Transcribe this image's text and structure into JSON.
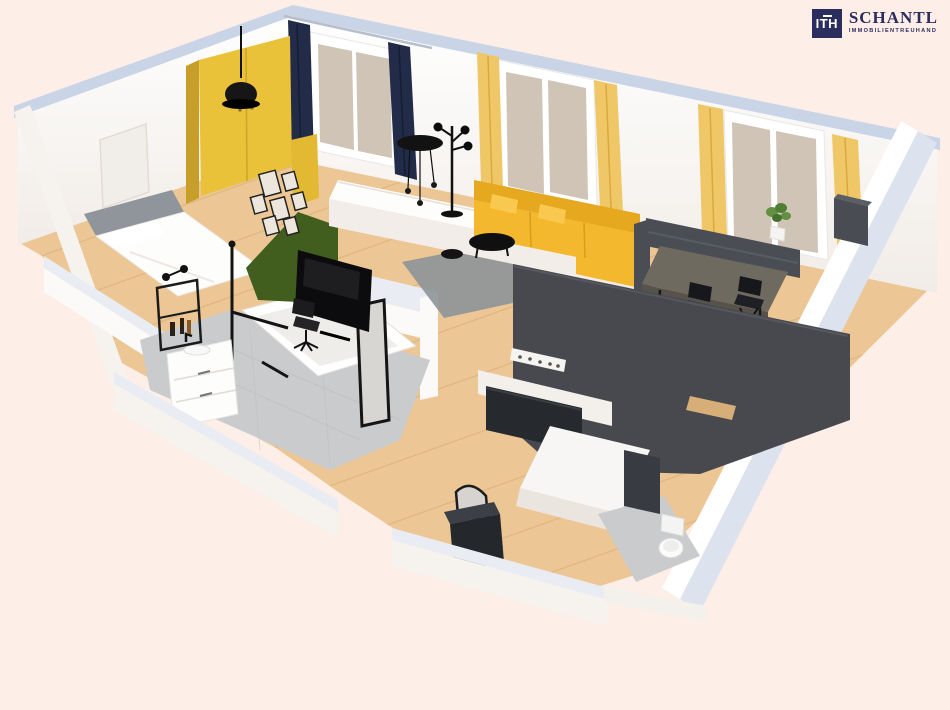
{
  "page": {
    "background_color": "#fdeee8"
  },
  "logo": {
    "mark": "ITH",
    "company": "SCHANTL",
    "tagline": "IMMOBILIENTREUHAND",
    "color": "#2b2d5e"
  },
  "scene": {
    "type": "3d-floor-plan-render",
    "rooms": [
      "bedroom",
      "bathroom",
      "living-area",
      "dining-area",
      "kitchen",
      "entry-hall",
      "wc"
    ],
    "furniture": [
      "bed",
      "wardrobe",
      "pendant-lamp",
      "picture-frames",
      "green-partition",
      "tv",
      "office-chair",
      "bathtub",
      "vanity",
      "wall-shelf",
      "standing-mirror",
      "corner-sofa",
      "coffee-table",
      "side-table",
      "floor-lamp",
      "hanging-lamp",
      "rug",
      "console-sideboard",
      "dining-bench",
      "dining-table",
      "folding-chairs",
      "sideboard-cabinet",
      "coat-rack",
      "kitchen-counter",
      "kitchen-island",
      "arched-mirror",
      "shoe-cabinet",
      "toilet",
      "plant",
      "window-curtains"
    ]
  },
  "colors": {
    "background": "#fdeee8",
    "logo_navy": "#2b2d5e",
    "wall_top": "#c9d5e6",
    "wood": "#ecc795",
    "wood_line": "#d9ad76",
    "tile": "#c9cbcd",
    "rug": "#8e9499",
    "anthracite": "#47494e",
    "counter_black": "#26292d",
    "black": "#141414",
    "wardrobe_yellow": "#e9c23a",
    "sofa_yellow": "#f4b82e",
    "sofa_yellow_dark": "#e6a81f",
    "curtain_yellow": "#f0c767",
    "curtain_navy": "#222b47",
    "green_wall": "#415e1e"
  }
}
